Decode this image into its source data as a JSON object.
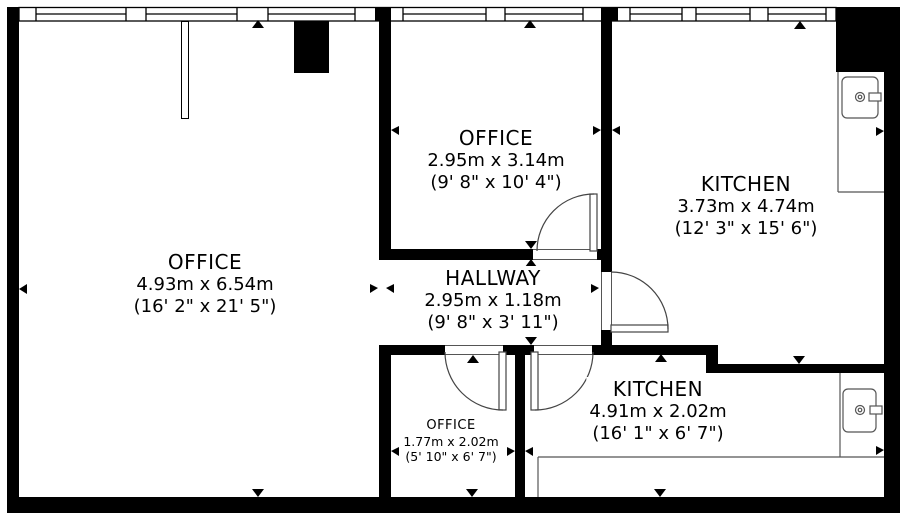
{
  "title": "Floor plan",
  "colors": {
    "wall": "#000000",
    "line": "#444444",
    "fixture_line": "#555555",
    "background": "#ffffff"
  },
  "rooms": {
    "office_main": {
      "name": "OFFICE",
      "metric": "4.93m x 6.54m",
      "imperial": "(16' 2\" x 21' 5\")"
    },
    "office_top": {
      "name": "OFFICE",
      "metric": "2.95m x 3.14m",
      "imperial": "(9' 8\" x 10' 4\")"
    },
    "kitchen_top": {
      "name": "KITCHEN",
      "metric": "3.73m x 4.74m",
      "imperial": "(12' 3\" x 15' 6\")"
    },
    "hallway": {
      "name": "HALLWAY",
      "metric": "2.95m x 1.18m",
      "imperial": "(9' 8\" x 3' 11\")"
    },
    "office_small": {
      "name": "OFFICE",
      "metric": "1.77m x 2.02m",
      "imperial": "(5' 10\" x 6' 7\")"
    },
    "kitchen_bottom": {
      "name": "KITCHEN",
      "metric": "4.91m x 2.02m",
      "imperial": "(16' 1\" x 6' 7\")"
    }
  },
  "fixtures": {
    "sinks": 2,
    "doors": 4,
    "windows": 8,
    "chimney_blocks": 2
  }
}
